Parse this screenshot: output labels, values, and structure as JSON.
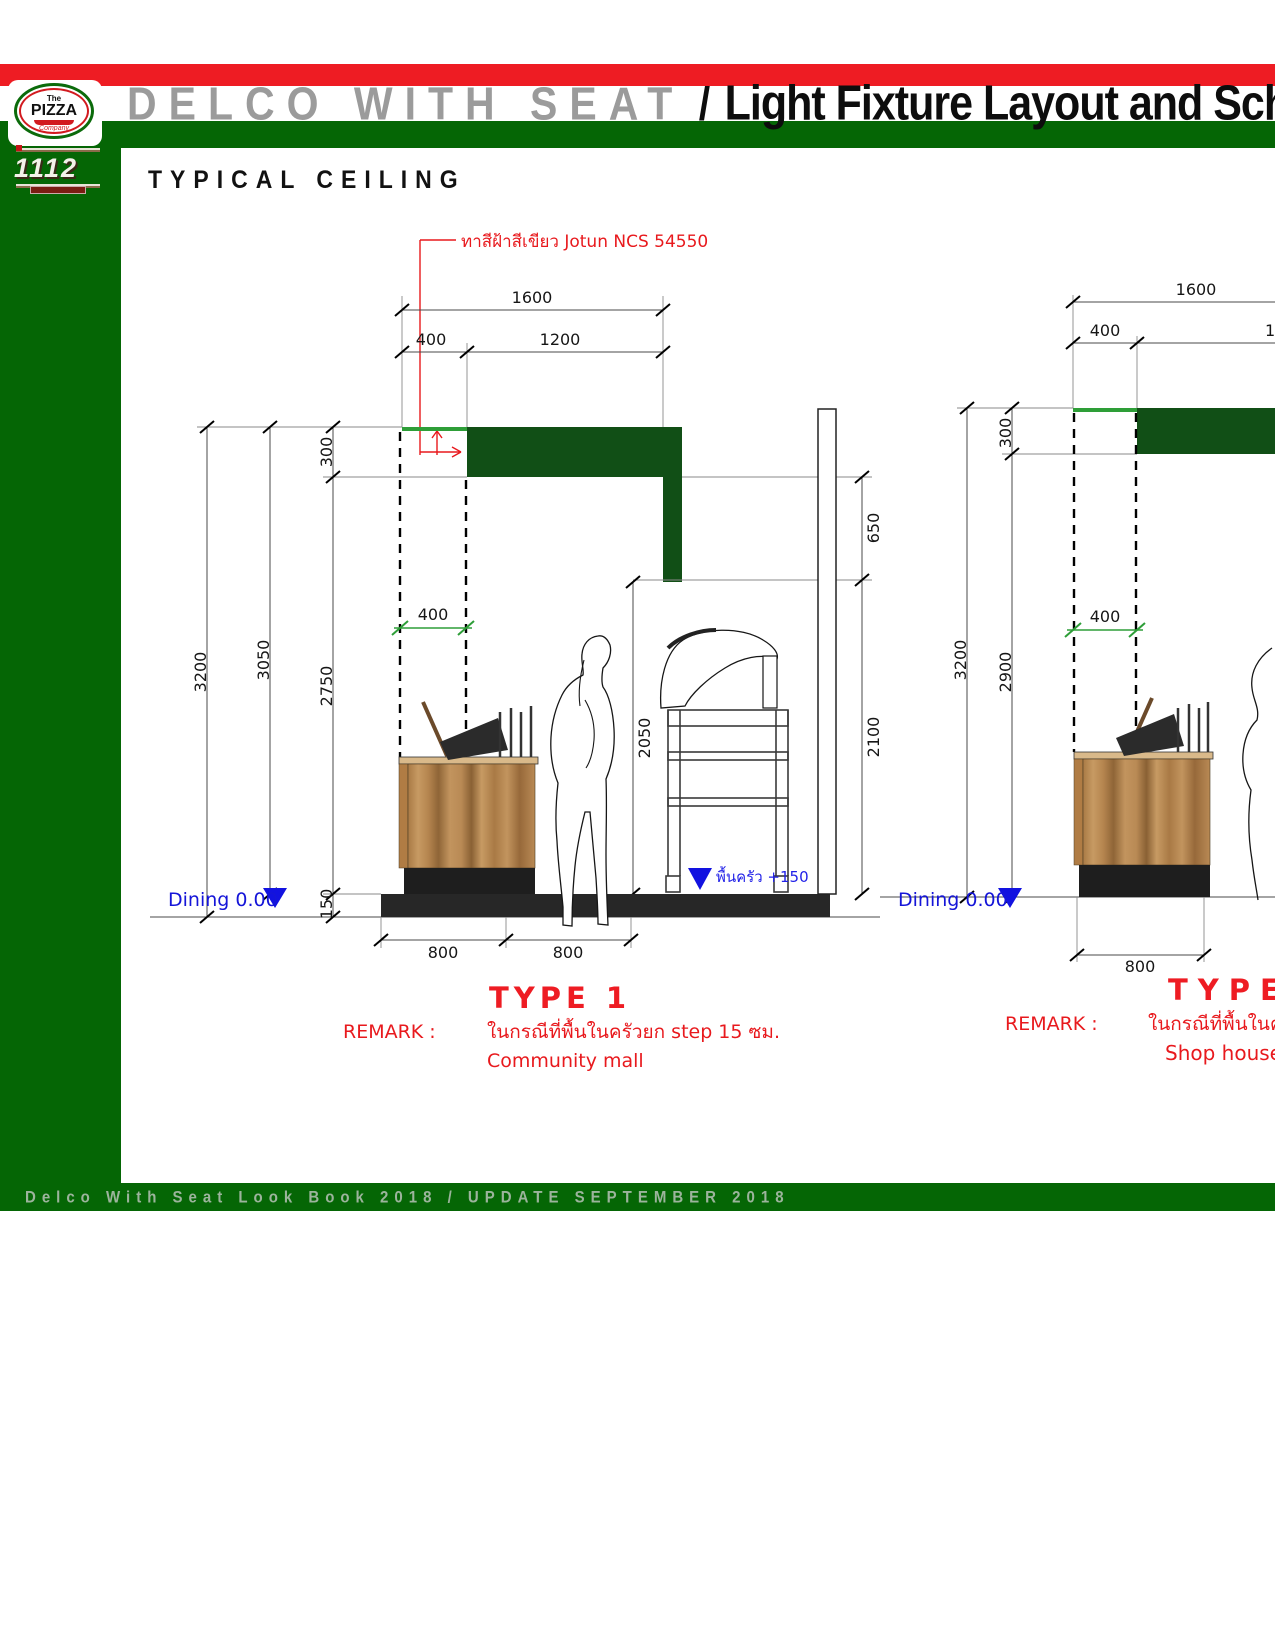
{
  "header": {
    "title_gray": "DELCO WITH SEAT",
    "title_sep": "/",
    "title_black": "Light Fixture Layout and Schedule"
  },
  "logo": {
    "the": "The",
    "pizza": "PIZZA",
    "company": "Company",
    "phone": "1112"
  },
  "section_title": "TYPICAL CEILING",
  "footer_text": "Delco With Seat Look Book 2018 / UPDATE SEPTEMBER 2018",
  "colors": {
    "band_red": "#ee1c23",
    "frame_green": "#056605",
    "bulkhead_green": "#114f16",
    "dim_green": "#2e9e38",
    "annotation_red": "#e8191d",
    "level_blue": "#1515d8",
    "title_gray": "#9b9b9b"
  },
  "type1": {
    "annotation": "ทาสีฝ้าสีเขียว Jotun NCS 54550",
    "dim_1600": "1600",
    "dim_400_top": "400",
    "dim_1200": "1200",
    "dim_300": "300",
    "dim_3200": "3200",
    "dim_3050": "3050",
    "dim_2750": "2750",
    "dim_400_mid": "400",
    "dim_2050": "2050",
    "dim_650": "650",
    "dim_2100": "2100",
    "dim_150": "150",
    "dim_800_a": "800",
    "dim_800_b": "800",
    "level_dining": "Dining 0.00",
    "level_kitchen": "พื้นครัว +150",
    "type_label": "TYPE 1",
    "remark_label": "REMARK :",
    "remark_line1": "ในกรณีที่พื้นในครัวยก step 15 ซม.",
    "remark_line2": "Community mall"
  },
  "type2": {
    "dim_1600": "1600",
    "dim_400_top": "400",
    "dim_1200": "1200",
    "dim_300": "300",
    "dim_3200": "3200",
    "dim_2900": "2900",
    "dim_400_mid": "400",
    "dim_800": "800",
    "level_dining": "Dining 0.00",
    "type_label": "TYPE 2",
    "remark_label": "REMARK :",
    "remark_line1": "ในกรณีที่พื้นในครัว",
    "remark_line2": "Shop house"
  }
}
